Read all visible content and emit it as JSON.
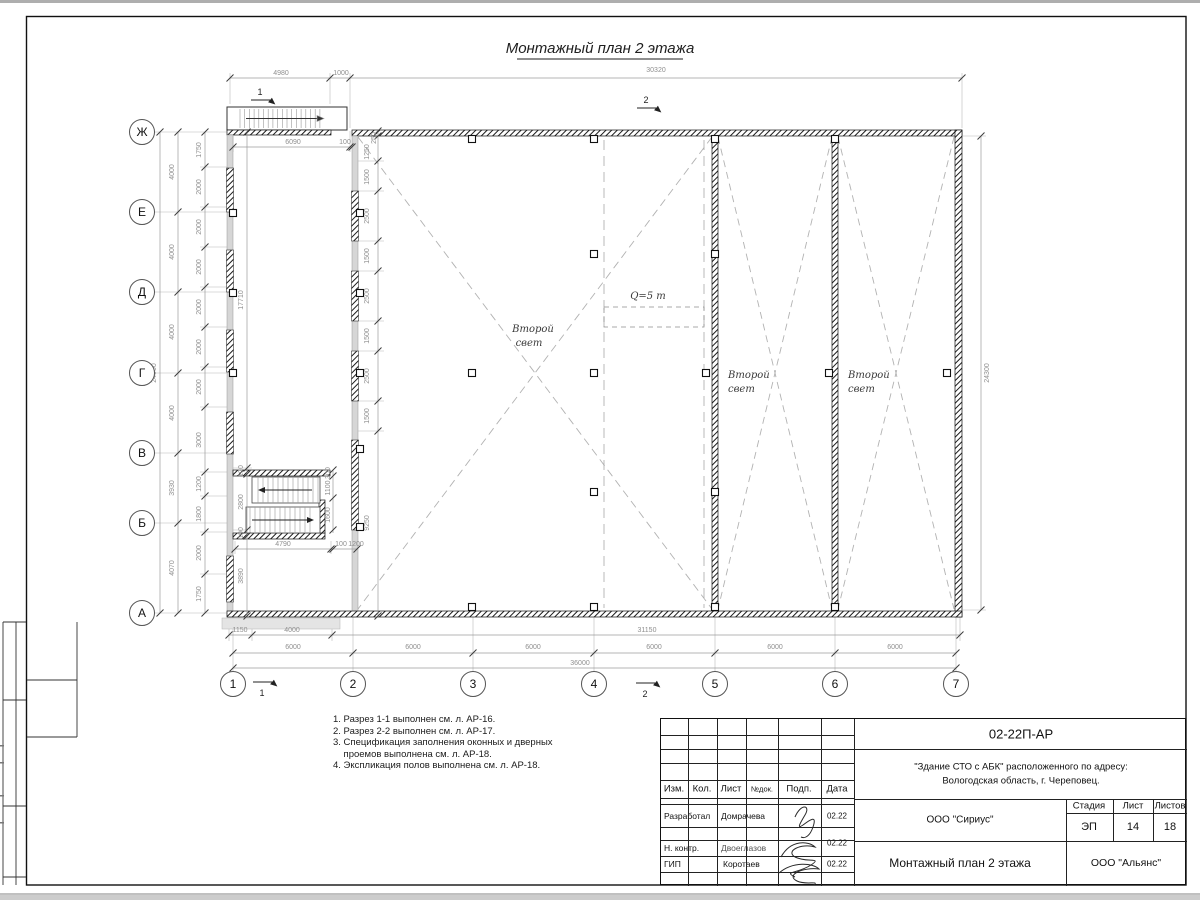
{
  "sheet": {
    "title": "Монтажный план 2 этажа",
    "doc_number": "02-22П-АР",
    "project_line1": "\"Здание СТО с АБК\" расположенного по адресу:",
    "project_line2": "Вологодская область, г. Череповец.",
    "developer_org": "ООО \"Сириус\"",
    "customer_org": "ООО \"Альянс\"",
    "drawing_name": "Монтажный план 2 этажа",
    "stage_label": "Стадия",
    "sheet_label": "Лист",
    "sheets_label": "Листов",
    "stage": "ЭП",
    "sheet_no": "14",
    "sheets_total": "18",
    "header_cols": [
      "Изм.",
      "Кол.",
      "Лист",
      "№док.",
      "Подп.",
      "Дата"
    ],
    "roles": [
      {
        "role": "Разработал",
        "name": "Домрачева",
        "date": "02.22"
      },
      {
        "role": "Н. контр.",
        "name": "Двоеглазов",
        "date": "02.22"
      },
      {
        "role": "ГИП",
        "name": "Коротаев",
        "date": "02.22"
      }
    ]
  },
  "notes": [
    "1. Разрез 1-1 выполнен см. л. АР-16.",
    "2. Разрез 2-2 выполнен см. л. АР-17.",
    "3. Спецификация заполнения оконных и дверных",
    "    проемов выполнена см. л. АР-18.",
    "4. Экспликация полов выполнена см. л. АР-18."
  ],
  "plan": {
    "axis_rows": [
      {
        "l": "Ж",
        "y": 132
      },
      {
        "l": "Е",
        "y": 212
      },
      {
        "l": "Д",
        "y": 292
      },
      {
        "l": "Г",
        "y": 373
      },
      {
        "l": "В",
        "y": 453
      },
      {
        "l": "Б",
        "y": 523
      },
      {
        "l": "А",
        "y": 613
      }
    ],
    "axis_cols": [
      {
        "l": "1",
        "x": 233
      },
      {
        "l": "2",
        "x": 353
      },
      {
        "l": "3",
        "x": 473
      },
      {
        "l": "4",
        "x": 594
      },
      {
        "l": "5",
        "x": 715
      },
      {
        "l": "6",
        "x": 835
      },
      {
        "l": "7",
        "x": 956
      }
    ],
    "dims": [
      {
        "t": "4980",
        "x": 281,
        "y": 75
      },
      {
        "t": "1000",
        "x": 341,
        "y": 75
      },
      {
        "t": "30320",
        "x": 656,
        "y": 72
      },
      {
        "t": "6090",
        "x": 293,
        "y": 144
      },
      {
        "t": "100",
        "x": 345,
        "y": 144
      },
      {
        "t": "250",
        "x": 376,
        "y": 138,
        "r": 1
      },
      {
        "t": "1250",
        "x": 369,
        "y": 152,
        "r": 1
      },
      {
        "t": "1500",
        "x": 369,
        "y": 177,
        "r": 1
      },
      {
        "t": "2500",
        "x": 369,
        "y": 216,
        "r": 1
      },
      {
        "t": "1500",
        "x": 369,
        "y": 256,
        "r": 1
      },
      {
        "t": "2500",
        "x": 369,
        "y": 296,
        "r": 1
      },
      {
        "t": "1500",
        "x": 369,
        "y": 336,
        "r": 1
      },
      {
        "t": "2500",
        "x": 369,
        "y": 376,
        "r": 1
      },
      {
        "t": "1500",
        "x": 369,
        "y": 416,
        "r": 1
      },
      {
        "t": "9250",
        "x": 369,
        "y": 523,
        "r": 1
      },
      {
        "t": "24000",
        "x": 156,
        "y": 373,
        "r": 1
      },
      {
        "t": "4000",
        "x": 174,
        "y": 172,
        "r": 1
      },
      {
        "t": "4000",
        "x": 174,
        "y": 252,
        "r": 1
      },
      {
        "t": "4000",
        "x": 174,
        "y": 332,
        "r": 1
      },
      {
        "t": "4000",
        "x": 174,
        "y": 413,
        "r": 1
      },
      {
        "t": "3930",
        "x": 174,
        "y": 488,
        "r": 1
      },
      {
        "t": "4070",
        "x": 174,
        "y": 568,
        "r": 1
      },
      {
        "t": "1750",
        "x": 201,
        "y": 150,
        "r": 1
      },
      {
        "t": "2000",
        "x": 201,
        "y": 187,
        "r": 1
      },
      {
        "t": "2000",
        "x": 201,
        "y": 227,
        "r": 1
      },
      {
        "t": "2000",
        "x": 201,
        "y": 267,
        "r": 1
      },
      {
        "t": "2000",
        "x": 201,
        "y": 307,
        "r": 1
      },
      {
        "t": "2000",
        "x": 201,
        "y": 347,
        "r": 1
      },
      {
        "t": "2000",
        "x": 201,
        "y": 387,
        "r": 1
      },
      {
        "t": "3000",
        "x": 201,
        "y": 440,
        "r": 1
      },
      {
        "t": "1200",
        "x": 201,
        "y": 484,
        "r": 1
      },
      {
        "t": "1800",
        "x": 201,
        "y": 514,
        "r": 1
      },
      {
        "t": "2000",
        "x": 201,
        "y": 553,
        "r": 1
      },
      {
        "t": "1750",
        "x": 201,
        "y": 594,
        "r": 1
      },
      {
        "t": "17710",
        "x": 243,
        "y": 300,
        "r": 1
      },
      {
        "t": "100",
        "x": 243,
        "y": 471,
        "r": 1
      },
      {
        "t": "2800",
        "x": 243,
        "y": 502,
        "r": 1
      },
      {
        "t": "100",
        "x": 243,
        "y": 533,
        "r": 1
      },
      {
        "t": "3890",
        "x": 243,
        "y": 576,
        "r": 1
      },
      {
        "t": "300",
        "x": 330,
        "y": 473,
        "r": 1
      },
      {
        "t": "1100",
        "x": 330,
        "y": 488,
        "r": 1
      },
      {
        "t": "1600",
        "x": 330,
        "y": 515,
        "r": 1
      },
      {
        "t": "4790",
        "x": 283,
        "y": 546
      },
      {
        "t": "100",
        "x": 341,
        "y": 546
      },
      {
        "t": "1200",
        "x": 356,
        "y": 546
      },
      {
        "t": "1150",
        "x": 240,
        "y": 632
      },
      {
        "t": "4000",
        "x": 292,
        "y": 632
      },
      {
        "t": "31150",
        "x": 647,
        "y": 632
      },
      {
        "t": "6000",
        "x": 293,
        "y": 649
      },
      {
        "t": "6000",
        "x": 413,
        "y": 649
      },
      {
        "t": "6000",
        "x": 533,
        "y": 649
      },
      {
        "t": "6000",
        "x": 654,
        "y": 649
      },
      {
        "t": "6000",
        "x": 775,
        "y": 649
      },
      {
        "t": "6000",
        "x": 895,
        "y": 649
      },
      {
        "t": "36000",
        "x": 580,
        "y": 665
      },
      {
        "t": "24300",
        "x": 989,
        "y": 373,
        "r": 1
      }
    ],
    "italics": [
      {
        "t": "Второй",
        "x": 533,
        "y": 332,
        "a": "middle"
      },
      {
        "t": "свет",
        "x": 529,
        "y": 346,
        "a": "middle"
      },
      {
        "t": "Второй",
        "x": 728,
        "y": 378,
        "a": "start"
      },
      {
        "t": "свет",
        "x": 728,
        "y": 392,
        "a": "start"
      },
      {
        "t": "Второй",
        "x": 848,
        "y": 378,
        "a": "start"
      },
      {
        "t": "свет",
        "x": 848,
        "y": 392,
        "a": "start"
      },
      {
        "t": "Q=5 т",
        "x": 648,
        "y": 299,
        "a": "middle"
      }
    ],
    "section_marks": [
      {
        "t": "1",
        "x": 260,
        "y": 95,
        "lx": 251,
        "ly": 100
      },
      {
        "t": "2",
        "x": 646,
        "y": 103,
        "lx": 637,
        "ly": 108
      },
      {
        "t": "1",
        "x": 262,
        "y": 696,
        "lx": 253,
        "ly": 682
      },
      {
        "t": "2",
        "x": 645,
        "y": 697,
        "lx": 636,
        "ly": 683
      }
    ]
  }
}
